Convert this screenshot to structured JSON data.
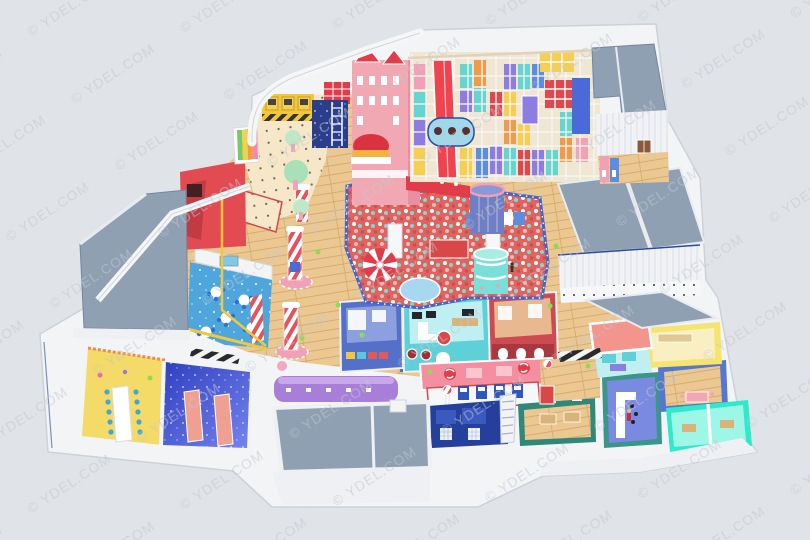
{
  "watermark": {
    "text": "© YDEL.COM"
  },
  "palette": {
    "bg": "#e0e3e7",
    "wall": "#f3f4f6",
    "wallEdge": "#cdd2d8",
    "band": "#eef0f3",
    "roof": "#8fa0b3",
    "roofEdge": "#7486a0",
    "wood": "#ebc892",
    "cream": "#f5e7c8",
    "ballpitBase": "#e0635d",
    "pitBorder": "#4a63c4",
    "castlePink": "#f2a8b2",
    "castlePinkDark": "#e88fa0",
    "red": "#e03c4a",
    "slideRed": "#ef4450",
    "crownGold": "#f2b441",
    "frameTan": "#efe6d4",
    "teal": "#66d4cf",
    "purple": "#8d7ce2",
    "yellow": "#f6cf52",
    "orange": "#f09a4a",
    "blue": "#5b8ee0",
    "navy": "#24409c",
    "tubeBlue": "#9fd8e8",
    "towerPurple": "#6f7fc4",
    "towerTeal": "#7adfd8",
    "cafeFloor": "#4fa6dd",
    "chairBlue": "#2f6fd8",
    "galaxy": "#3b4ed1",
    "bench": "#f0a090",
    "partyYellow": "#f4da66",
    "canopyPink": "#f48fa2",
    "machineBlue": "#2f55c0",
    "greenWall": "#2f8878",
    "barWall": "#3a9688",
    "barFloor": "#7a8ae0",
    "roomBlue": "#5577d0",
    "roomYellow": "#f5e570",
    "salmonRoof": "#f2958c",
    "tealGlow": "#2fe9cb",
    "tealGlowFloor": "#9ef7e6",
    "counterPurple": "#a87fd8",
    "railYellow": "#f2c83a",
    "mint": "#bfe8c8",
    "trunkPink": "#e8a8b8",
    "balloonGreen": "#8ade4a",
    "houseTeal": "#5fd0d8",
    "houseRed": "#cc4a50",
    "climbNavy": "#2a3e8c",
    "watermarkColor": "#c2c7d1"
  },
  "scene": {
    "areas": [
      {
        "id": "ball-pit",
        "color_key": "ballpitBase"
      },
      {
        "id": "castle-tower",
        "color_key": "castlePink"
      },
      {
        "id": "play-structure",
        "color_key": "frameTan"
      },
      {
        "id": "red-slide",
        "color_key": "slideRed"
      },
      {
        "id": "toddler-zone",
        "color_key": "cream"
      },
      {
        "id": "cafe-seating",
        "color_key": "cafeFloor"
      },
      {
        "id": "galaxy-party-room",
        "color_key": "galaxy"
      },
      {
        "id": "yellow-party-room",
        "color_key": "partyYellow"
      },
      {
        "id": "roleplay-houses",
        "color_key": "houseTeal"
      },
      {
        "id": "reception-canopy",
        "color_key": "canopyPink"
      },
      {
        "id": "roof-slabs",
        "color_key": "roof"
      }
    ]
  }
}
